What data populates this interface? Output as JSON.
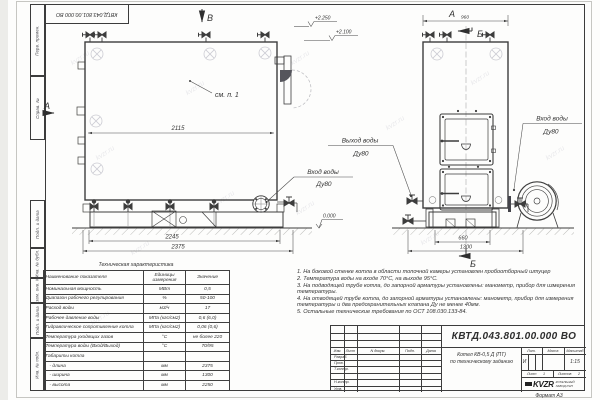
{
  "watermark": "kvzr.ru",
  "frame": {
    "stamp_top": "КВТД.043.801.00.000 ВО",
    "format_note": "Формат А3",
    "side_cells": {
      "perv": "Перв. примен.",
      "sprav": "Справ. №",
      "podp1": "Подп. и дата",
      "inv_dubl": "Инв. № дубл.",
      "vzam": "Взам. инв. №",
      "podp2": "Подп. и дата",
      "inv_podl": "Инв. № подл."
    }
  },
  "drawing": {
    "view_b_arrow": "В",
    "view_a_arrow": "А",
    "view_a_title": "А",
    "section_b_top": "Б",
    "section_b_bottom": "Б",
    "callout_see": "см. п. 1",
    "dim_960": "960",
    "dim_2115": "2115",
    "dim_2245": "2245",
    "dim_2375": "2375",
    "dim_660": "660",
    "dim_1300": "1300",
    "elev_2250": "+2.250",
    "elev_2100": "+2.100",
    "elev_0": "0.000",
    "label_outlet_line1": "Выход воды",
    "label_outlet_line2": "Ду80",
    "label_inlet_front_line1": "Вход воды",
    "label_inlet_front_line2": "Ду80",
    "label_inlet_side_line1": "Вход воды",
    "label_inlet_side_line2": "Ду80"
  },
  "tech_table": {
    "title": "Техническая характеристика",
    "col_name": "Наименование показателя",
    "col_units_1": "Единицы",
    "col_units_2": "измерения",
    "col_value": "Значение",
    "rows": [
      [
        "Номинальная мощность",
        "МВт",
        "0,5"
      ],
      [
        "Диапазон рабочего регулирования",
        "%",
        "50-100"
      ],
      [
        "Расход воды",
        "м3/ч",
        "17"
      ],
      [
        "Рабочее давление воды",
        "МПа (кгс/см2)",
        "0,6 (6,0)"
      ],
      [
        "Гидравлическое сопротивление котла",
        "МПа (кгс/см2)",
        "0,06 (0,6)"
      ],
      [
        "Температура уходящих газов",
        "°С",
        "не более 220"
      ],
      [
        "Температура воды (Вход/Выход)",
        "°С",
        "70/95"
      ],
      [
        "Габариты котла",
        "",
        ""
      ],
      [
        "   - длина",
        "мм",
        "2375"
      ],
      [
        "   - ширина",
        "мм",
        "1300"
      ],
      [
        "   - высота",
        "мм",
        "2250"
      ]
    ]
  },
  "notes": {
    "n1": "1.  На боковой стенке котла в области топочной камеры установлен пробоотборный штуцер",
    "n2": "2.  Температура воды на входе  70°С,  на выходе  95°С.",
    "n3": "3.  На подводящей трубе котла, до запорной арматуры установлены:  манометр,  прибор для измерения температуры.",
    "n4": "4.  На отводящей трубе котла, до запорной арматуры установлены:  манометр,  прибор для измерения температуры и два предохранительных клапана  Ду не менее  40мм.",
    "n5": "5.  Остальные технические требования по ОСТ  108.030.133-84."
  },
  "title_block": {
    "doc_number": "КВТД.043.801.00.000  ВО",
    "product_line1": "Котел  КВ-0,5  Д  (ПТ)",
    "product_line2": "по техническому заданию",
    "h_izm": "Изм.",
    "h_list": "Лист",
    "h_docnum": "N докум.",
    "h_podp": "Подп.",
    "h_data": "Дата",
    "r_razrab": "Разраб.",
    "r_prov": "Пров.",
    "r_tkontr": "Т.контр.",
    "r_nkontr": "Н.контр.",
    "r_utv": "Утв.",
    "lit_label": "Лит.",
    "lit_value": "И",
    "mass_label": "Масса",
    "scale_label": "Масштаб",
    "scale_value": "1:15",
    "sheet_label": "Лист",
    "sheet_value": "1",
    "sheets_label": "Листов",
    "sheets_value": "2",
    "logo_text": "KVZR",
    "company_line1": "КОТЕЛЬНЫЙ",
    "company_line2": "ЗАВОД РЭП"
  }
}
